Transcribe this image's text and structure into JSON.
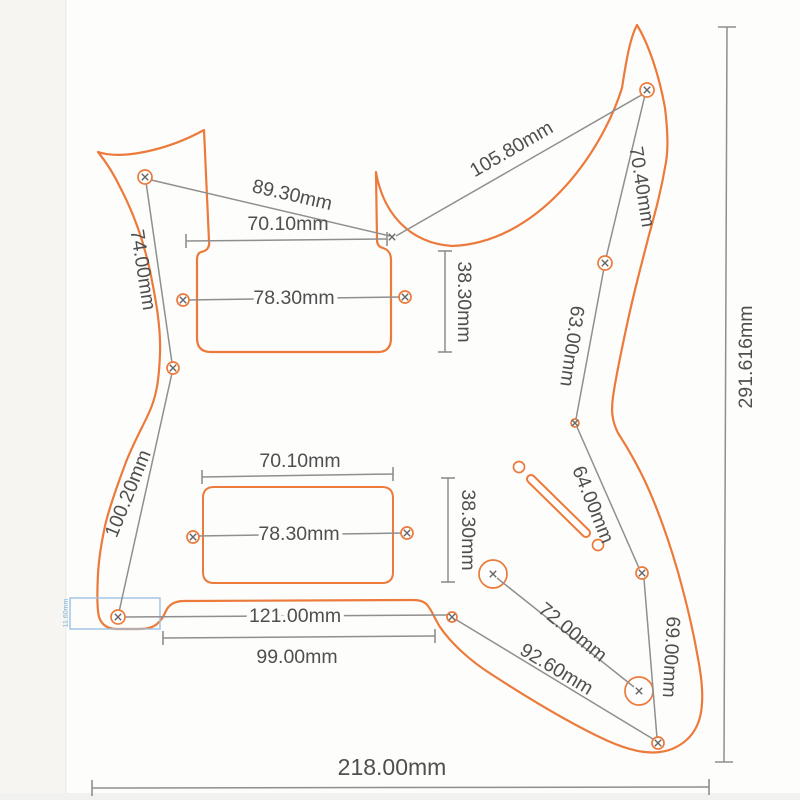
{
  "title": "Guitar pickguard dimension drawing",
  "unit": "mm",
  "colors": {
    "outline_orange": "#ec7a3a",
    "dimension_gray": "#8f8f8f",
    "label_gray": "#4f4f4f",
    "annotation_blue": "#85b2d4"
  },
  "labels": {
    "dim_89_30": "89.30mm",
    "dim_105_80": "105.80mm",
    "dim_70_10_neck": "70.10mm",
    "dim_78_30_neck": "78.30mm",
    "dim_38_30_neck": "38.30mm",
    "dim_74_00": "74.00mm",
    "dim_70_40": "70.40mm",
    "dim_63_00": "63.00mm",
    "dim_100_20": "100.20mm",
    "dim_70_10_bridge": "70.10mm",
    "dim_78_30_bridge": "78.30mm",
    "dim_38_30_bridge": "38.30mm",
    "dim_64_00": "64.00mm",
    "dim_121_00": "121.00mm",
    "dim_99_00": "99.00mm",
    "dim_72_00": "72.00mm",
    "dim_92_60": "92.60mm",
    "dim_69_00": "69.00mm",
    "dim_218_00": "218.00mm",
    "dim_291_616": "291.616mm",
    "neck_heel_height": "11.60mm"
  }
}
